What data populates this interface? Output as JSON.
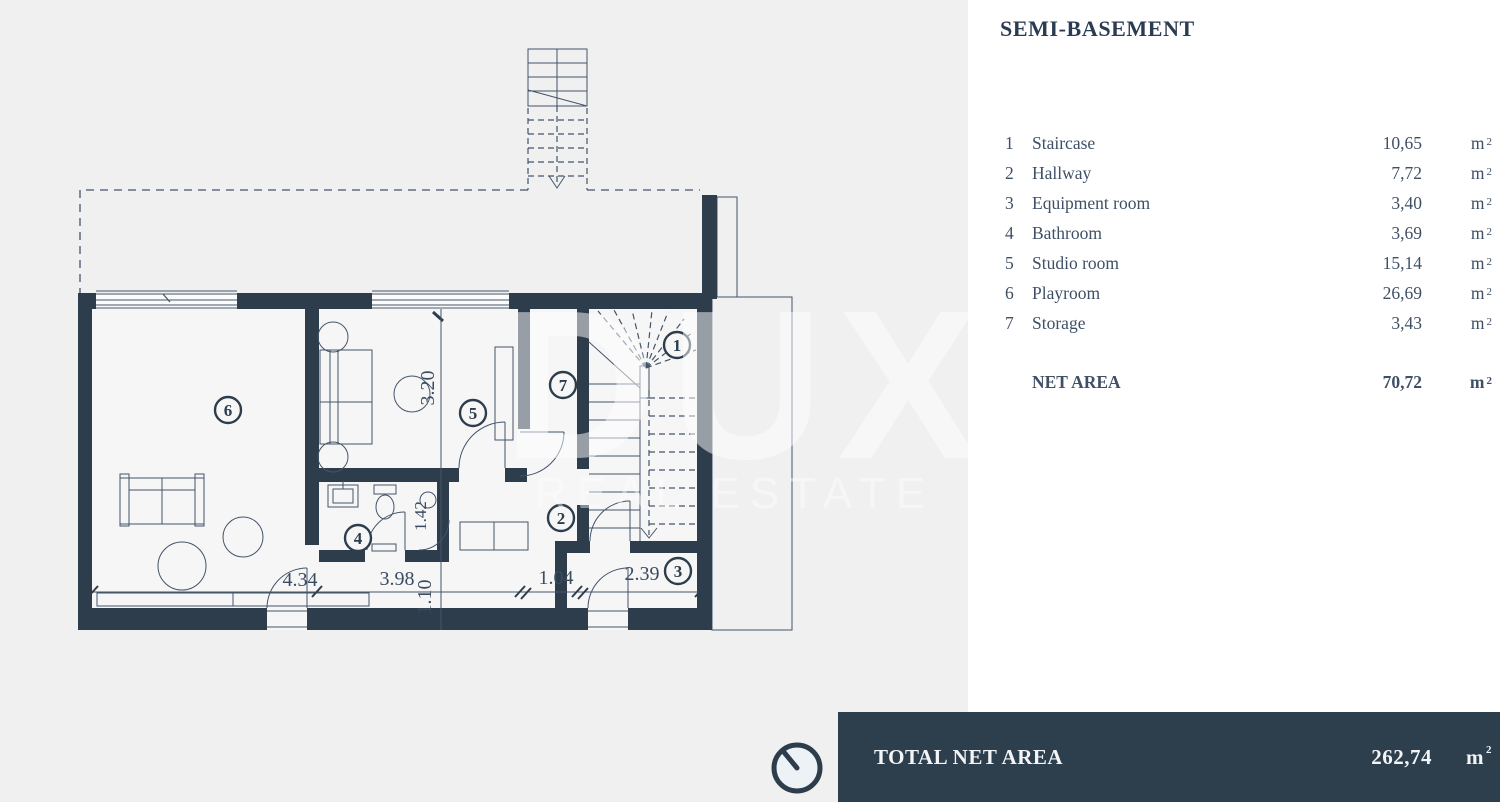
{
  "legend": {
    "title": "SEMI-BASEMENT",
    "rows": [
      {
        "num": "1",
        "label": "Staircase",
        "value": "10,65"
      },
      {
        "num": "2",
        "label": "Hallway",
        "value": "7,72"
      },
      {
        "num": "3",
        "label": "Equipment room",
        "value": "3,40"
      },
      {
        "num": "4",
        "label": "Bathroom",
        "value": "3,69"
      },
      {
        "num": "5",
        "label": "Studio room",
        "value": "15,14"
      },
      {
        "num": "6",
        "label": "Playroom",
        "value": "26,69"
      },
      {
        "num": "7",
        "label": "Storage",
        "value": "3,43"
      }
    ],
    "net_area_label": "NET AREA",
    "net_area_value": "70,72",
    "unit": "m",
    "unit_sup": "2"
  },
  "footer": {
    "label": "TOTAL NET AREA",
    "value": "262,74",
    "unit": "m",
    "unit_sup": "2"
  },
  "plan": {
    "watermark_primary": "DUX",
    "watermark_secondary": "REAL ESTATE",
    "rooms": {
      "r1": "1",
      "r2": "2",
      "r3": "3",
      "r4": "4",
      "r5": "5",
      "r6": "6",
      "r7": "7"
    },
    "dims": {
      "playroom_width": "4.34",
      "hall_width": "3.98",
      "hall_depth": "1.10",
      "corridor_width": "1.04",
      "equipment_width": "2.39",
      "studio_depth": "3.20",
      "wc_depth": "1.42"
    }
  },
  "colors": {
    "wall": "#2e3d4c",
    "background_grey": "#f0f0f1",
    "bar": "#2d3e4d",
    "text": "#3f5066"
  }
}
